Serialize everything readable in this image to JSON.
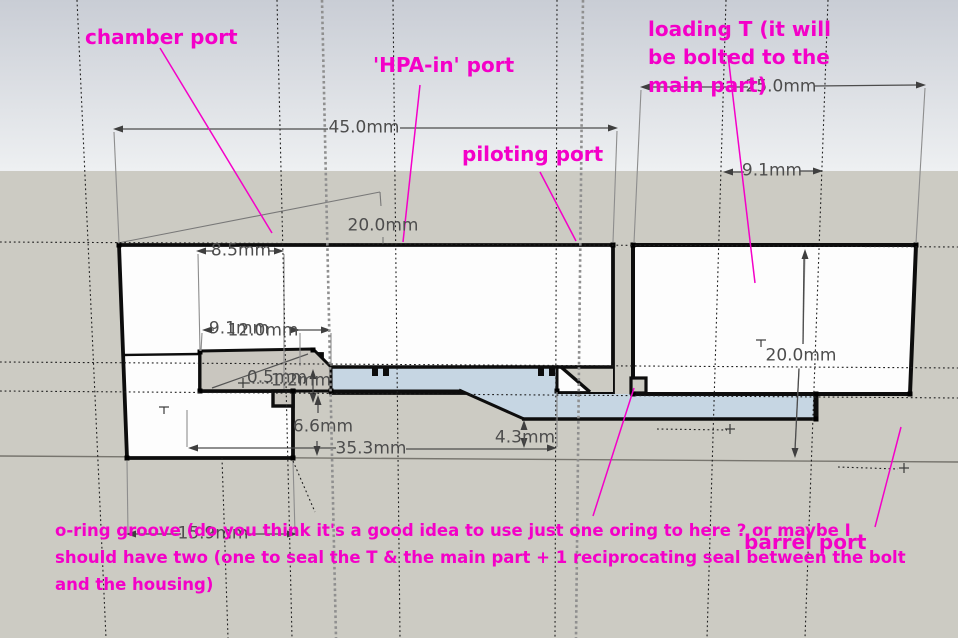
{
  "annotations": {
    "chamber_port": "chamber port",
    "hpa_in_port": "'HPA-in' port",
    "piloting_port": "piloting port",
    "loading_t_line1": "loading T (it will",
    "loading_t_line2": "be bolted to the",
    "loading_t_line3": "main part)",
    "barrel_port": "barrel port",
    "oring_note_line1": "o-ring groove (do you think it's a good idea to use just one oring to here ? or maybe I",
    "oring_note_line2": "should have two (one to seal the T & the main part + 1 reciprocating seal between the bolt",
    "oring_note_line3": "and the housing)"
  },
  "dimensions": {
    "main_width": "45.0mm",
    "t_width": "25.0mm",
    "t_bore": "9.1mm",
    "main_height": "20.0mm",
    "d85": "8.5mm",
    "d91_mid": "9.1mm",
    "d120": "12.0mm",
    "d05": "0.5mm",
    "d12": "1.2mm",
    "d66": "6.6mm",
    "d353": "35.3mm",
    "d43": "4.3mm",
    "d159": "15.9mm",
    "t_height": "20.0mm"
  },
  "colors": {
    "annotation_magenta": "#f400c8",
    "dimension_gray": "#4d4d4d",
    "sky_top": "#c9cdd5",
    "sky_bottom": "#eef0f2",
    "ground": "#cccbc3",
    "part_fill": "#fdfdfd",
    "bore_fill": "#c6d6e3",
    "edge_black": "#0d0d0d"
  }
}
